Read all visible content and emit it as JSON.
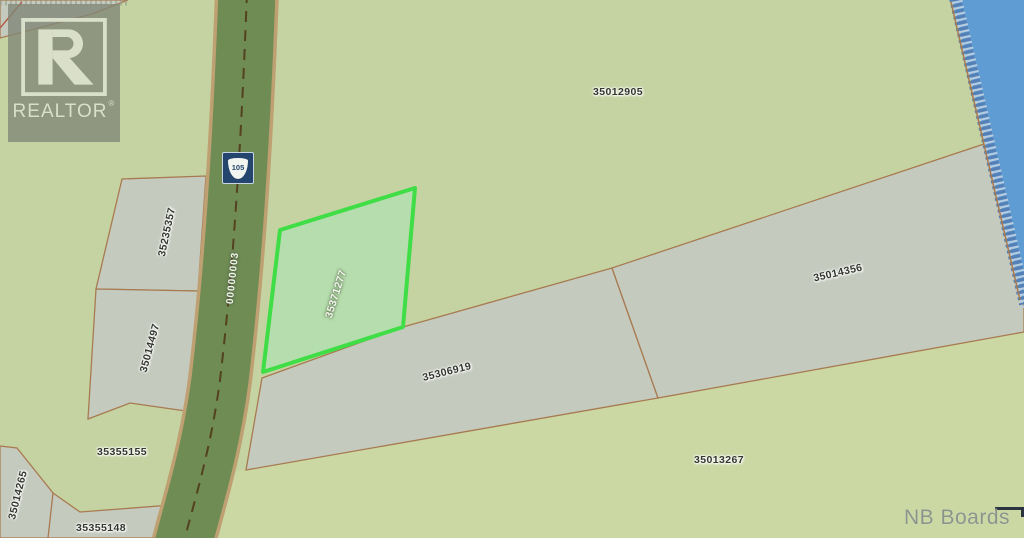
{
  "map_title": "Cadastral parcel map",
  "watermark": {
    "brand": "REALTOR",
    "registered": "®"
  },
  "footer": {
    "credit": "NB Boards"
  },
  "road": {
    "route": "105",
    "label": "00000003"
  },
  "highlight_parcel": {
    "id": "35371277"
  },
  "parcels": [
    {
      "id": "35012905"
    },
    {
      "id": "35235357"
    },
    {
      "id": "35014497"
    },
    {
      "id": "35355155"
    },
    {
      "id": "35014265"
    },
    {
      "id": "35355148"
    },
    {
      "id": "35306919"
    },
    {
      "id": "35014356"
    },
    {
      "id": "35013267"
    }
  ],
  "colors": {
    "land_green": "#c5d3a2",
    "lowland_green": "#cbd8a4",
    "parcel_grey": "#c5cabe",
    "boundary_brown": "#a87a50",
    "road_fill": "#6f8c55",
    "road_casing": "#bfa072",
    "road_centerline": "#54411f",
    "water_blue": "#5e9cd3",
    "shore_hatch": "#5580b5",
    "highlight_fill": "#b6ddad",
    "highlight_border": "#3fdd46",
    "shield_navy": "#24456e"
  }
}
